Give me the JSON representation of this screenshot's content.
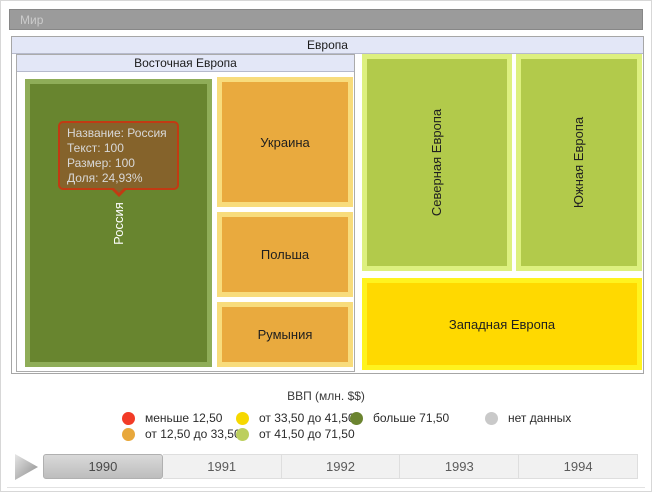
{
  "window": {
    "root_label": "Мир"
  },
  "treemap": {
    "europe": "Европа",
    "eastern_europe": "Восточная Европа",
    "russia": "Россия",
    "ukraine": "Украина",
    "poland": "Польша",
    "romania": "Румыния",
    "northern_europe": "Северная Европа",
    "southern_europe": "Южная Европа",
    "western_europe": "Западная Европа",
    "colors": {
      "russia_fill": "#68852f",
      "russia_border": "#8fad58",
      "orange_fill": "#e9aa3e",
      "orange_border": "#f8dc7c",
      "yellowgreen_fill": "#b2ca4b",
      "yellowgreen_border": "#ddf07f",
      "yellow_fill": "#ffd900",
      "yellow_border": "#fff31e",
      "header_fill": "#e3e7f7",
      "root_bar_fill": "#9b9b9b"
    }
  },
  "tooltip": {
    "line1": "Название: Россия",
    "line2": "Текст: 100",
    "line3": "Размер: 100",
    "line4": "Доля: 24,93%",
    "fill": "#85632b",
    "border": "#c23a13"
  },
  "legend": {
    "title": "ВВП (млн. $$)",
    "items": [
      {
        "label": "меньше 12,50",
        "color": "#f23b27"
      },
      {
        "label": "от 12,50 до 33,50",
        "color": "#e8a83c"
      },
      {
        "label": "от 33,50 до 41,50",
        "color": "#f6d800"
      },
      {
        "label": "от 41,50 до 71,50",
        "color": "#bccf5e"
      },
      {
        "label": "больше 71,50",
        "color": "#6b8430"
      },
      {
        "label": "нет данных",
        "color": "#c9c9c9"
      }
    ]
  },
  "timeline": {
    "play_icon": "play-icon",
    "years": [
      {
        "label": "1990",
        "selected": true
      },
      {
        "label": "1991",
        "selected": false
      },
      {
        "label": "1992",
        "selected": false
      },
      {
        "label": "1993",
        "selected": false
      },
      {
        "label": "1994",
        "selected": false
      }
    ]
  },
  "chart_data": {
    "type": "treemap",
    "title": "ВВП (млн. $$)",
    "root": "Мир",
    "selected_year": "1990",
    "timeline_years": [
      "1990",
      "1991",
      "1992",
      "1993",
      "1994"
    ],
    "legend_bins": [
      {
        "label": "меньше 12,50",
        "color": "#f23b27"
      },
      {
        "label": "от 12,50 до 33,50",
        "color": "#e8a83c"
      },
      {
        "label": "от 33,50 до 41,50",
        "color": "#f6d800"
      },
      {
        "label": "от 41,50 до 71,50",
        "color": "#bccf5e"
      },
      {
        "label": "больше 71,50",
        "color": "#6b8430"
      },
      {
        "label": "нет данных",
        "color": "#c9c9c9"
      }
    ],
    "tree": {
      "name": "Мир",
      "children": [
        {
          "name": "Европа",
          "children": [
            {
              "name": "Восточная Европа",
              "children": [
                {
                  "name": "Россия",
                  "text": 100,
                  "size": 100,
                  "share_pct": 24.93,
                  "bin": "больше 71,50"
                },
                {
                  "name": "Украина",
                  "bin": "от 12,50 до 33,50"
                },
                {
                  "name": "Польша",
                  "bin": "от 12,50 до 33,50"
                },
                {
                  "name": "Румыния",
                  "bin": "от 12,50 до 33,50"
                }
              ]
            },
            {
              "name": "Северная Европа",
              "bin": "от 41,50 до 71,50"
            },
            {
              "name": "Южная Европа",
              "bin": "от 41,50 до 71,50"
            },
            {
              "name": "Западная Европа",
              "bin": "от 33,50 до 41,50"
            }
          ]
        }
      ]
    }
  }
}
